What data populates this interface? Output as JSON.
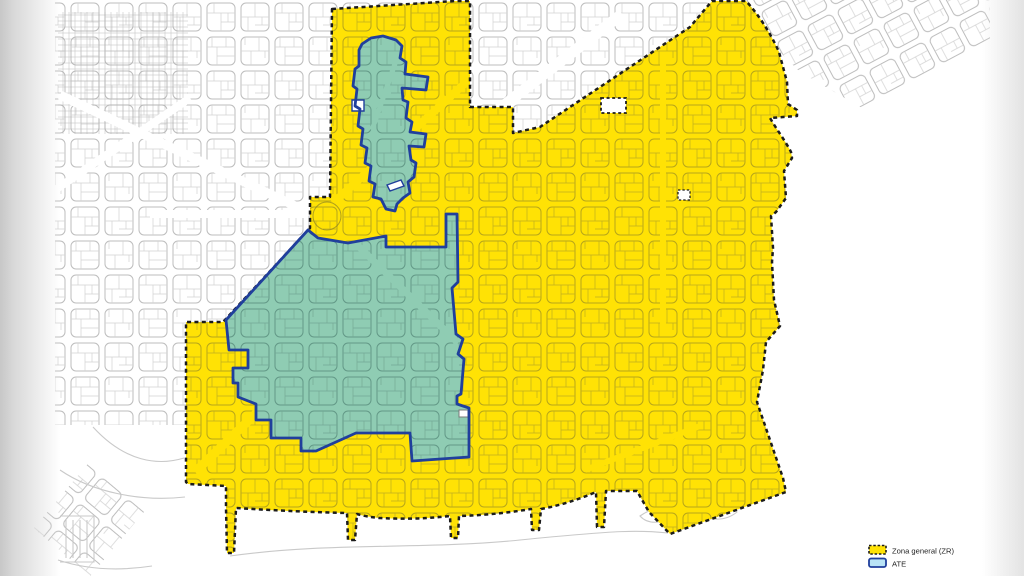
{
  "legend": {
    "items": [
      {
        "label": "Zona general (ZR)",
        "fill": "#ffe205",
        "border": "#1c1c1c",
        "border_style": "dashed"
      },
      {
        "label": "ATE",
        "fill": "#b9e3f6",
        "border": "#203f9c",
        "border_style": "solid"
      }
    ]
  },
  "colors": {
    "zr_fill": "#ffe205",
    "zr_border": "#1c1c1c",
    "ate_fill": "#8fccb3",
    "ate_border": "#203f9c",
    "street_grid": "#bdbdbd",
    "water_lines": "#c9c9c9"
  },
  "map": {
    "zones": [
      {
        "name": "zona-general-zr",
        "fill": "#ffe205",
        "stroke": "#1c1c1c",
        "path": "M332,9 L455,1 L470,1 L470,107 L513,107 L513,133 L540,127 L690,27 L712,1 L746,1 C758,14 770,32 779,52 L787,82 L788,104 L797,110 L797,116 L770,118 C777,130 786,142 791,152 L792,158 L784,171 L786,198 L776,212 L771,216 L773,248 L772,262 L774,300 L780,326 L766,342 L763,370 L757,402 L783,478 L786,492 L670,534 L649,512 L637,491 L606,491 L604,527 L597,527 L596,492 Q568,504 541,509 L539,530 L532,530 L531,509 Q495,515 459,516 L458,538 L451,538 L450,516 Q415,520 380,518 Q367,517 357,514 L355,540 L348,540 L347,513 Q300,512 236,508 L234,553 L227,553 L226,508 L226,486 L188,484 L186,482 L186,322 L223,322 L310,228 L310,197 L330,197 L332,9 Z"
      },
      {
        "name": "ate-lower",
        "fill": "#8fccb3",
        "stroke": "#203f9c",
        "path": "M308,230 L318,238 L348,243 L386,236 L386,247 L446,247 L446,214 L457,214 L458,282 L452,288 L456,334 L463,339 L458,354 L464,359 L461,394 L457,396 L457,404 L469,408 L469,457 L412,461 L410,433 L356,433 L316,451 L301,451 L301,438 L271,438 L271,420 L256,420 L256,404 L238,397 L238,383 L233,383 L233,368 L248,368 L248,350 L229,350 L226,320 Z"
      },
      {
        "name": "ate-upper",
        "fill": "#8fccb3",
        "stroke": "#203f9c",
        "path": "M362,44 L371,38 L383,36 L396,40 L402,46 L400,58 L406,62 L405,74 L428,77 L426,90 L402,88 L403,100 L408,102 L406,118 L412,122 L410,132 L426,134 L424,147 L409,146 L411,160 L416,163 L414,177 L408,182 L410,193 L403,198 L397,204 L395,211 L386,209 L381,199 L373,197 L375,184 L369,181 L371,166 L365,163 L367,148 L361,145 L363,129 L358,126 L360,109 L355,106 L357,89 L353,86 L355,69 L359,66 L359,50 Z"
      }
    ],
    "holes": [
      {
        "name": "zr-hole-large",
        "path": "M601,98 h25 v15 h-25 Z"
      },
      {
        "name": "zr-hole-small",
        "path": "M678,190 h12 v10 h-12 Z"
      },
      {
        "name": "ate-upper-hole",
        "path": "M352,100 h12 v11 h-12 Z"
      },
      {
        "name": "ate-upper-slash",
        "path": "M387,185 l14,-5 l3,6 l-14,5 Z"
      },
      {
        "name": "ate-lower-hole",
        "path": "M459,410 h9 v7 h-9 Z"
      }
    ],
    "avenues": {
      "white": [
        "M60,95 L310,213",
        "M55,190 L190,98",
        "M468,133 L622,14",
        "M150,214 L308,214"
      ],
      "yellow": [
        "M195,472 L348,325",
        "M333,203 L472,77",
        "M663,58 L663,332",
        "M585,470 L700,426"
      ],
      "teal": [
        "M352,240 L458,343",
        "M398,55 L372,130"
      ]
    },
    "water": [
      "M93,427 C125,462 158,466 184,458",
      "M60,470 C92,492 140,502 185,497",
      "M230,556 C330,542 420,550 520,540 S640,530 668,533",
      "M640,516 q20,-14 45,-6 q18,6 30,0 q14,-8 22,2 q-12,10 -30,6 q-25,-4 -40,2 q-18,6 -27,-4 Z",
      "M58,560 Q100,574 152,566",
      "M60,516 h34 v46 h-34 M66,520 v38 M73,520 v38 M80,520 v38 M87,520 v38"
    ],
    "tr_grid_clip": "M713,0 L990,0 L990,42 L930,75 L862,108 L800,72 L758,30 L745,0 Z"
  }
}
